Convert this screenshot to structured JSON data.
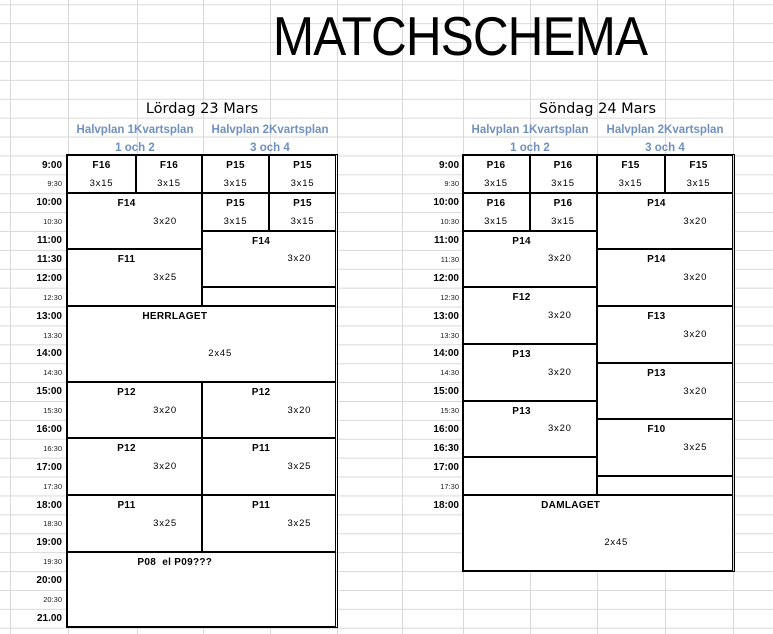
{
  "page": {
    "title_cell": "MATCHSCHEMA"
  },
  "colors": {
    "header_blue": "#7090c0",
    "gridline": "#d9d9d9",
    "box_border": "#000000",
    "text": "#000000",
    "background": "#ffffff"
  },
  "days": [
    {
      "name": "Lördag 23 Mars",
      "halvplans": [
        {
          "title": "Halvplan 1Kvartsplan",
          "subtitle": "1 och 2"
        },
        {
          "title": "Halvplan 2Kvartsplan",
          "subtitle": "3 och 4"
        }
      ],
      "times": [
        {
          "label": "9:00",
          "minor": false
        },
        {
          "label": "9:30",
          "minor": true
        },
        {
          "label": "10:00",
          "minor": false
        },
        {
          "label": "10:30",
          "minor": true
        },
        {
          "label": "11:00",
          "minor": false
        },
        {
          "label": "11:30",
          "minor": false
        },
        {
          "label": "12:00",
          "minor": false
        },
        {
          "label": "12:30",
          "minor": true
        },
        {
          "label": "13:00",
          "minor": false
        },
        {
          "label": "13:30",
          "minor": true
        },
        {
          "label": "14:00",
          "minor": false
        },
        {
          "label": "14:30",
          "minor": true
        },
        {
          "label": "15:00",
          "minor": false
        },
        {
          "label": "15:30",
          "minor": true
        },
        {
          "label": "16:00",
          "minor": false
        },
        {
          "label": "16:30",
          "minor": true
        },
        {
          "label": "17:00",
          "minor": false
        },
        {
          "label": "17:30",
          "minor": true
        },
        {
          "label": "18:00",
          "minor": false
        },
        {
          "label": "18:30",
          "minor": true
        },
        {
          "label": "19:00",
          "minor": false
        },
        {
          "label": "19:30",
          "minor": true
        },
        {
          "label": "20:00",
          "minor": false
        },
        {
          "label": "20:30",
          "minor": true
        },
        {
          "label": "21.00",
          "minor": false
        }
      ],
      "matches": [
        {
          "label": "F16",
          "format": "3x15",
          "col": 0,
          "cols": 1,
          "row": 0,
          "rows": 2
        },
        {
          "label": "F16",
          "format": "3x15",
          "col": 1,
          "cols": 1,
          "row": 0,
          "rows": 2
        },
        {
          "label": "P15",
          "format": "3x15",
          "col": 2,
          "cols": 1,
          "row": 0,
          "rows": 2
        },
        {
          "label": "P15",
          "format": "3x15",
          "col": 3,
          "cols": 1,
          "row": 0,
          "rows": 2
        },
        {
          "label": "F14",
          "format": "3x20",
          "col": 0,
          "cols": 2,
          "row": 2,
          "rows": 3
        },
        {
          "label": "P15",
          "format": "3x15",
          "col": 2,
          "cols": 1,
          "row": 2,
          "rows": 2
        },
        {
          "label": "P15",
          "format": "3x15",
          "col": 3,
          "cols": 1,
          "row": 2,
          "rows": 2
        },
        {
          "label": "F14",
          "format": "3x20",
          "col": 2,
          "cols": 2,
          "row": 4,
          "rows": 3
        },
        {
          "label": "F11",
          "format": "3x25",
          "col": 0,
          "cols": 2,
          "row": 5,
          "rows": 3
        },
        {
          "label": "",
          "format": "",
          "col": 2,
          "cols": 2,
          "row": 7,
          "rows": 1
        },
        {
          "label": "HERRLAGET",
          "format": "2x45",
          "col": 0,
          "cols": 4,
          "row": 8,
          "rows": 4,
          "big": true
        },
        {
          "label": "P12",
          "format": "3x20",
          "col": 0,
          "cols": 2,
          "row": 12,
          "rows": 3
        },
        {
          "label": "P12",
          "format": "3x20",
          "col": 2,
          "cols": 2,
          "row": 12,
          "rows": 3
        },
        {
          "label": "P12",
          "format": "3x20",
          "col": 0,
          "cols": 2,
          "row": 15,
          "rows": 3
        },
        {
          "label": "P11",
          "format": "3x25",
          "col": 2,
          "cols": 2,
          "row": 15,
          "rows": 3
        },
        {
          "label": "P11",
          "format": "3x25",
          "col": 0,
          "cols": 2,
          "row": 18,
          "rows": 3
        },
        {
          "label": "P11",
          "format": "3x25",
          "col": 2,
          "cols": 2,
          "row": 18,
          "rows": 3
        },
        {
          "label": "P08  el P09???",
          "format": "",
          "col": 0,
          "cols": 4,
          "row": 21,
          "rows": 4
        }
      ]
    },
    {
      "name": "Söndag 24 Mars",
      "halvplans": [
        {
          "title": "Halvplan 1Kvartsplan",
          "subtitle": "1 och 2"
        },
        {
          "title": "Halvplan 2Kvartsplan",
          "subtitle": "3 och 4"
        }
      ],
      "times": [
        {
          "label": "9:00",
          "minor": false
        },
        {
          "label": "9:30",
          "minor": true
        },
        {
          "label": "10:00",
          "minor": false
        },
        {
          "label": "10:30",
          "minor": true
        },
        {
          "label": "11:00",
          "minor": false
        },
        {
          "label": "11:30",
          "minor": true
        },
        {
          "label": "12:00",
          "minor": false
        },
        {
          "label": "12:30",
          "minor": true
        },
        {
          "label": "13:00",
          "minor": false
        },
        {
          "label": "13:30",
          "minor": true
        },
        {
          "label": "14:00",
          "minor": false
        },
        {
          "label": "14:30",
          "minor": true
        },
        {
          "label": "15:00",
          "minor": false
        },
        {
          "label": "15:30",
          "minor": true
        },
        {
          "label": "16:00",
          "minor": false
        },
        {
          "label": "16:30",
          "minor": false
        },
        {
          "label": "17:00",
          "minor": false
        },
        {
          "label": "17:30",
          "minor": true
        },
        {
          "label": "18:00",
          "minor": false
        }
      ],
      "matches": [
        {
          "label": "P16",
          "format": "3x15",
          "col": 0,
          "cols": 1,
          "row": 0,
          "rows": 2
        },
        {
          "label": "P16",
          "format": "3x15",
          "col": 1,
          "cols": 1,
          "row": 0,
          "rows": 2
        },
        {
          "label": "F15",
          "format": "3x15",
          "col": 2,
          "cols": 1,
          "row": 0,
          "rows": 2
        },
        {
          "label": "F15",
          "format": "3x15",
          "col": 3,
          "cols": 1,
          "row": 0,
          "rows": 2
        },
        {
          "label": "P16",
          "format": "3x15",
          "col": 0,
          "cols": 1,
          "row": 2,
          "rows": 2
        },
        {
          "label": "P16",
          "format": "3x15",
          "col": 1,
          "cols": 1,
          "row": 2,
          "rows": 2
        },
        {
          "label": "P14",
          "format": "3x20",
          "col": 2,
          "cols": 2,
          "row": 2,
          "rows": 3
        },
        {
          "label": "P14",
          "format": "3x20",
          "col": 0,
          "cols": 2,
          "row": 4,
          "rows": 3
        },
        {
          "label": "P14",
          "format": "3x20",
          "col": 2,
          "cols": 2,
          "row": 5,
          "rows": 3
        },
        {
          "label": "F12",
          "format": "3x20",
          "col": 0,
          "cols": 2,
          "row": 7,
          "rows": 3
        },
        {
          "label": "F13",
          "format": "3x20",
          "col": 2,
          "cols": 2,
          "row": 8,
          "rows": 3
        },
        {
          "label": "P13",
          "format": "3x20",
          "col": 0,
          "cols": 2,
          "row": 10,
          "rows": 3
        },
        {
          "label": "P13",
          "format": "3x20",
          "col": 2,
          "cols": 2,
          "row": 11,
          "rows": 3
        },
        {
          "label": "P13",
          "format": "3x20",
          "col": 0,
          "cols": 2,
          "row": 13,
          "rows": 3
        },
        {
          "label": "F10",
          "format": "3x25",
          "col": 2,
          "cols": 2,
          "row": 14,
          "rows": 3
        },
        {
          "label": "",
          "format": "",
          "col": 0,
          "cols": 2,
          "row": 16,
          "rows": 2
        },
        {
          "label": "",
          "format": "",
          "col": 2,
          "cols": 2,
          "row": 17,
          "rows": 1
        },
        {
          "label": "DAMLAGET",
          "format": "2x45",
          "col": 0,
          "cols": 4,
          "row": 18,
          "rows": 4,
          "big": true
        }
      ]
    }
  ]
}
